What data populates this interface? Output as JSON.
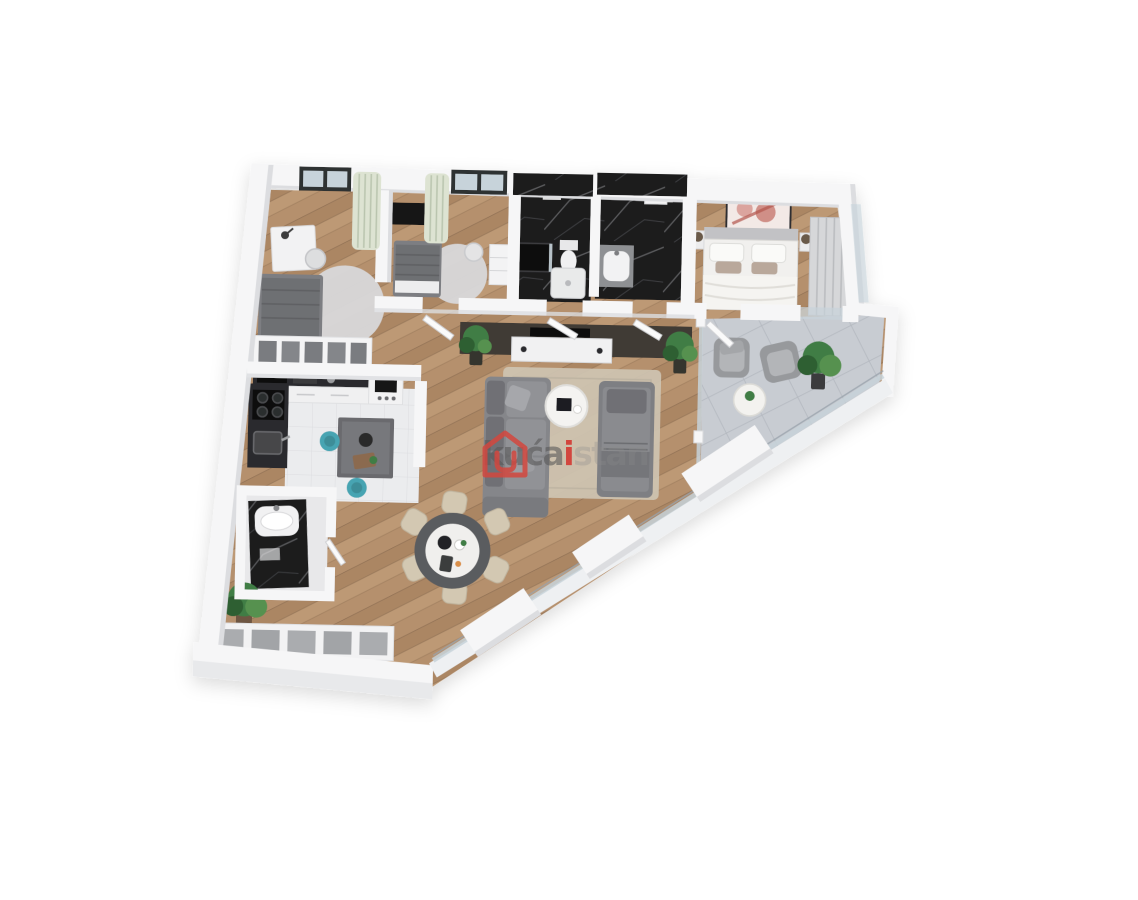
{
  "page": {
    "background": "#ffffff",
    "description": "3D rendered apartment floor plan, top-down isometric view on white background"
  },
  "watermark": {
    "logo": "house-logo",
    "prefix": "kuća",
    "accent": "i",
    "suffix": "stan"
  },
  "palette": {
    "bg": "#ffffff",
    "wall": "#f6f6f7",
    "wall-shade": "#dcdde0",
    "wall-edge": "#c9cbce",
    "wood": "#b5906d",
    "wood-dark": "#a27d5d",
    "wood-light": "#c5a17e",
    "kitchen-floor": "#ebecee",
    "marble-black": "#1a1b1d",
    "stone": "#c8ccd2",
    "stone-line": "#b2b7be",
    "rug-living": "#cec4b2",
    "rug-round": "#d8d8da",
    "sofa": "#85868a",
    "sofa-dark": "#6f7074",
    "bed-gray": "#6e6f73",
    "bedding-white": "#f1f0ee",
    "counter-dark": "#2b2c2e",
    "island": "#6a6b6e",
    "teal": "#47a4b2",
    "plant": "#3f7d44",
    "plant-dark": "#2e5e33",
    "plant-light": "#569150",
    "chair-beige": "#d3c8b2",
    "tv-wall": "#413b34",
    "curtain": "#dde3d2",
    "glass": "#c7d3da",
    "accent-red": "#d2463e",
    "wm-gray": "rgba(88,88,88,0.60)",
    "wm-light": "rgba(140,140,140,0.30)"
  },
  "scene": {
    "rooms": [
      {
        "name": "bedroom-left",
        "furniture": [
          "single bed",
          "desk with lamp",
          "chair",
          "round rug",
          "open wardrobe",
          "window with curtain"
        ]
      },
      {
        "name": "bedroom-middle",
        "furniture": [
          "single bed",
          "wall tv panel",
          "round rug",
          "desk chair",
          "cabinet",
          "window with curtain"
        ]
      },
      {
        "name": "bathroom-1",
        "furniture": [
          "black marble tiles",
          "shower",
          "toilet",
          "shower tray"
        ]
      },
      {
        "name": "bathroom-2",
        "furniture": [
          "black marble tiles",
          "washbasin counter",
          "wall cabinet"
        ]
      },
      {
        "name": "master-bedroom",
        "furniture": [
          "double bed",
          "wall art",
          "nightstands with lamps",
          "wardrobe"
        ]
      },
      {
        "name": "terrace",
        "furniture": [
          "two armchairs",
          "round side table",
          "potted plant",
          "stone tiles"
        ]
      },
      {
        "name": "living-room",
        "furniture": [
          "corner sofa",
          "daybed",
          "round coffee table",
          "tv console with dark panel",
          "area rug",
          "plants"
        ]
      },
      {
        "name": "kitchen",
        "furniture": [
          "l-shaped counter",
          "cooktop",
          "sink",
          "island",
          "two teal bar stools"
        ]
      },
      {
        "name": "wc",
        "furniture": [
          "black marble vanity with sink"
        ]
      },
      {
        "name": "dining-area",
        "furniture": [
          "round dining table",
          "six beige chairs"
        ]
      },
      {
        "name": "hallway",
        "furniture": [
          "potted plant",
          "built-in wardrobe",
          "diagonal glass wall"
        ]
      }
    ]
  }
}
